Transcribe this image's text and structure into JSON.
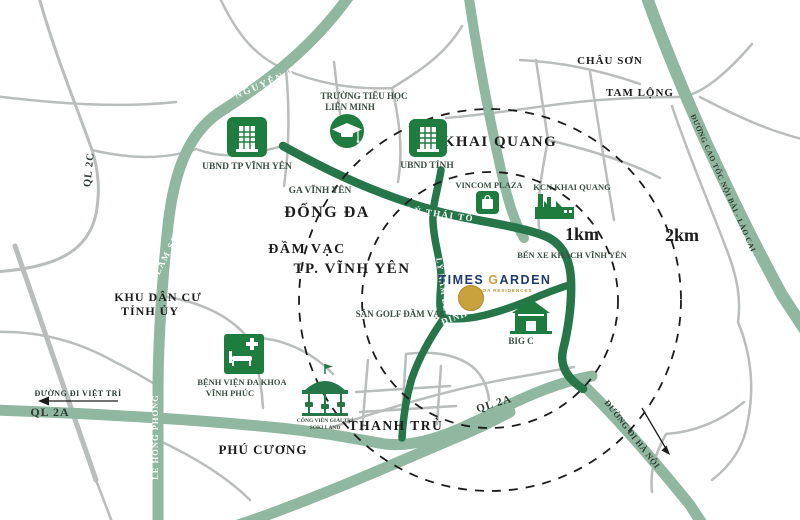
{
  "project": {
    "logo_times": "TIMES",
    "logo_g": "G",
    "logo_arden": "ARDEN",
    "tagline": "TINH HOA RESIDENCES",
    "colors": {
      "navy": "#1e3a6e",
      "gold": "#c9a23d"
    }
  },
  "distances": {
    "inner": "1km",
    "outer": "2km"
  },
  "areas": {
    "chau_son": "CHÂU SƠN",
    "tam_long": "TAM LỘNG",
    "khai_quang": "KHAI QUANG",
    "dong_da": "ĐỐNG ĐA",
    "dam_vac": "ĐẦM VẠC",
    "tp_vinh_yen": "TP. VĨNH YÊN",
    "khu_dan_cu_1": "KHU DÂN CƯ",
    "khu_dan_cu_2": "TỈNH ỦY",
    "phu_cuong": "PHÚ CƯƠNG",
    "thanh_tru": "THANH TRÙ"
  },
  "roads": {
    "nguyen_tat_thanh": "NGUYỄN TẤT THÀNH",
    "ql_2c": "QL 2C",
    "lam_son": "LAM SƠN",
    "le_hong_phong": "LÊ HỒNG PHONG",
    "ql_2a_left": "QL 2A",
    "ql_2a_right": "QL 2A",
    "ly_thai_to": "LÝ THÁI TỔ",
    "ly_nam_de": "LÝ NAM ĐẾ",
    "dinh_tien_hoang": "ĐINH TIÊN HOÀNG",
    "cao_toc_noi_bai_lao_cai": "ĐƯỜNG CAO TỐC NỘI BÀI - LÀO CAI",
    "duong_di_viet_tri": "ĐƯỜNG ĐI VIỆT TRÌ",
    "duong_di_ha_noi": "ĐƯỜNG ĐI HÀ NỘI"
  },
  "pois": {
    "ubnd_tp": "UBND TP VĨNH YÊN",
    "truong_tieu_hoc_1": "TRƯỜNG TIỂU HỌC",
    "truong_tieu_hoc_2": "LIÊN MINH",
    "ubnd_tinh": "UBND TỈNH",
    "vincom": "VINCOM PLAZA",
    "kcn_khai_quang": "KCN KHAI QUANG",
    "ga_vinh_yen": "GA VĨNH YÊN",
    "ben_xe": "BẾN XE KHÁCH VĨNH YÊN",
    "san_golf": "SÂN GOLF ĐẦM VẠC",
    "benh_vien_1": "BỆNH VIỆN ĐA KHOA",
    "benh_vien_2": "VĨNH PHÚC",
    "big_c": "BIG C",
    "cong_vien_1": "CÔNG VIÊN GIẢI TRÍ",
    "cong_vien_2": "SOKI LAND"
  },
  "colors": {
    "road_primary": "#27764a",
    "road_secondary": "#90b7a0",
    "road_minor": "#b9bdbb",
    "icon_green": "#1d7c3e",
    "radius_circle": "#1c1c1c"
  }
}
